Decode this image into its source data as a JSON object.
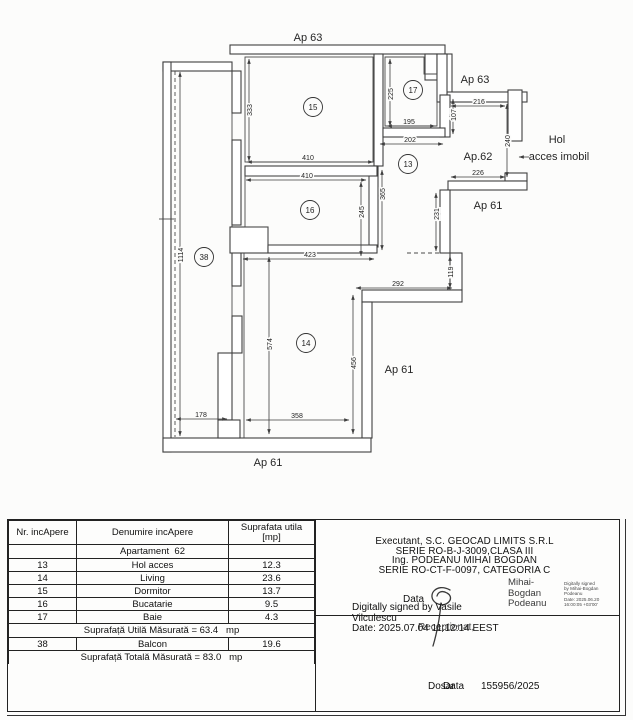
{
  "plan": {
    "neighbor_labels": [
      {
        "text": "Ap 63",
        "x": 308,
        "y": 41
      },
      {
        "text": "Ap 63",
        "x": 475,
        "y": 83
      },
      {
        "text": "Ap.62",
        "x": 478,
        "y": 160
      },
      {
        "text": "Ap 61",
        "x": 488,
        "y": 209
      },
      {
        "text": "Ap 61",
        "x": 399,
        "y": 373
      },
      {
        "text": "Ap 61",
        "x": 268,
        "y": 466
      }
    ],
    "access_label": {
      "line1": "Hol",
      "line2": "acces imobil"
    },
    "rooms": [
      {
        "num": "15",
        "x": 313,
        "y": 107
      },
      {
        "num": "17",
        "x": 413,
        "y": 90
      },
      {
        "num": "13",
        "x": 408,
        "y": 164
      },
      {
        "num": "16",
        "x": 310,
        "y": 210
      },
      {
        "num": "38",
        "x": 204,
        "y": 257
      },
      {
        "num": "14",
        "x": 306,
        "y": 343
      }
    ],
    "dimensions": [
      {
        "t": "333",
        "x1": 249,
        "y1": 59,
        "x2": 249,
        "y2": 161,
        "lx": 249,
        "ly": 110
      },
      {
        "t": "410",
        "x1": 247,
        "y1": 162,
        "x2": 373,
        "y2": 162,
        "lx": 308,
        "ly": 160
      },
      {
        "t": "410",
        "x1": 246,
        "y1": 180,
        "x2": 366,
        "y2": 180,
        "lx": 307,
        "ly": 178
      },
      {
        "t": "225",
        "x1": 390,
        "y1": 59,
        "x2": 390,
        "y2": 126,
        "lx": 390,
        "ly": 94
      },
      {
        "t": "195",
        "x1": 387,
        "y1": 126,
        "x2": 435,
        "y2": 126,
        "lx": 409,
        "ly": 124
      },
      {
        "t": "202",
        "x1": 380,
        "y1": 144,
        "x2": 443,
        "y2": 144,
        "lx": 410,
        "ly": 142
      },
      {
        "t": "107",
        "x1": 453,
        "y1": 99,
        "x2": 453,
        "y2": 134,
        "lx": 453,
        "ly": 115
      },
      {
        "t": "216",
        "x1": 451,
        "y1": 106,
        "x2": 505,
        "y2": 106,
        "lx": 479,
        "ly": 104
      },
      {
        "t": "240",
        "x1": 507,
        "y1": 104,
        "x2": 507,
        "y2": 177,
        "lx": 507,
        "ly": 141
      },
      {
        "t": "226",
        "x1": 451,
        "y1": 177,
        "x2": 505,
        "y2": 177,
        "lx": 478,
        "ly": 175
      },
      {
        "t": "365",
        "x1": 382,
        "y1": 170,
        "x2": 382,
        "y2": 250,
        "lx": 382,
        "ly": 194
      },
      {
        "t": "245",
        "x1": 361,
        "y1": 182,
        "x2": 361,
        "y2": 256,
        "lx": 361,
        "ly": 212
      },
      {
        "t": "423",
        "x1": 243,
        "y1": 259,
        "x2": 374,
        "y2": 259,
        "lx": 310,
        "ly": 257
      },
      {
        "t": "1114",
        "x1": 180,
        "y1": 72,
        "x2": 180,
        "y2": 436,
        "lx": 180,
        "ly": 255
      },
      {
        "t": "231",
        "x1": 436,
        "y1": 193,
        "x2": 436,
        "y2": 251,
        "lx": 436,
        "ly": 214
      },
      {
        "t": "119",
        "x1": 450,
        "y1": 256,
        "x2": 450,
        "y2": 288,
        "lx": 450,
        "ly": 272
      },
      {
        "t": "292",
        "x1": 356,
        "y1": 288,
        "x2": 452,
        "y2": 288,
        "lx": 398,
        "ly": 286
      },
      {
        "t": "574",
        "x1": 269,
        "y1": 257,
        "x2": 269,
        "y2": 434,
        "lx": 269,
        "ly": 344
      },
      {
        "t": "456",
        "x1": 353,
        "y1": 295,
        "x2": 353,
        "y2": 434,
        "lx": 353,
        "ly": 363
      },
      {
        "t": "178",
        "x1": 176,
        "y1": 419,
        "x2": 227,
        "y2": 419,
        "lx": 201,
        "ly": 417
      },
      {
        "t": "358",
        "x1": 246,
        "y1": 420,
        "x2": 349,
        "y2": 420,
        "lx": 297,
        "ly": 418
      }
    ]
  },
  "table": {
    "headers": {
      "col1": "Nr. incApere",
      "col2": "Denumire incApere",
      "col3a": "Suprafata utila",
      "col3b": "[mp]"
    },
    "apartment_row": "Apartament  62",
    "rows": [
      {
        "nr": "13",
        "name": "Hol acces",
        "area": "12.3"
      },
      {
        "nr": "14",
        "name": "Living",
        "area": "23.6"
      },
      {
        "nr": "15",
        "name": "Dormitor",
        "area": "13.7"
      },
      {
        "nr": "16",
        "name": "Bucatarie",
        "area": "9.5"
      },
      {
        "nr": "17",
        "name": "Baie",
        "area": "4.3"
      }
    ],
    "useful_total": "Suprafață Utilă Măsurată = 63.4   mp",
    "balcon_row": {
      "nr": "38",
      "name": "Balcon",
      "area": "19.6"
    },
    "grand_total": "Suprafață Totală Măsurată = 83.0   mp"
  },
  "executant": {
    "line1": "Executant, S.C. GEOCAD LIMITS S.R.L",
    "line2": "SERIE RO-B-J-3009,CLASA III",
    "line3": "Ing. PODEANU MIHAI BOGDAN",
    "line4": "SERIE RO-CT-F-0097, CATEGORIA C"
  },
  "signatures": {
    "podeanu_name1": "Mihai-",
    "podeanu_name2": "Bogdan",
    "podeanu_name3": "Podeanu",
    "stamp1": "Digitally signed",
    "stamp2": "by Mihai-Bogdan",
    "stamp3": "Podeanu",
    "stamp4": "Date: 2025.06.20",
    "stamp5": "16:00:05 +03'00'",
    "data_label": "Data",
    "vasile_line1": "Digitally signed by Vasile",
    "vasile_line2": "Vilculescu",
    "vasile_date": "Date: 2025.07.04 11:12:14 EEST",
    "receptionat_label": "Receptionat,",
    "dosar_label": "Dosar",
    "data_label2": "Data",
    "dosar_number": "155956/2025"
  }
}
